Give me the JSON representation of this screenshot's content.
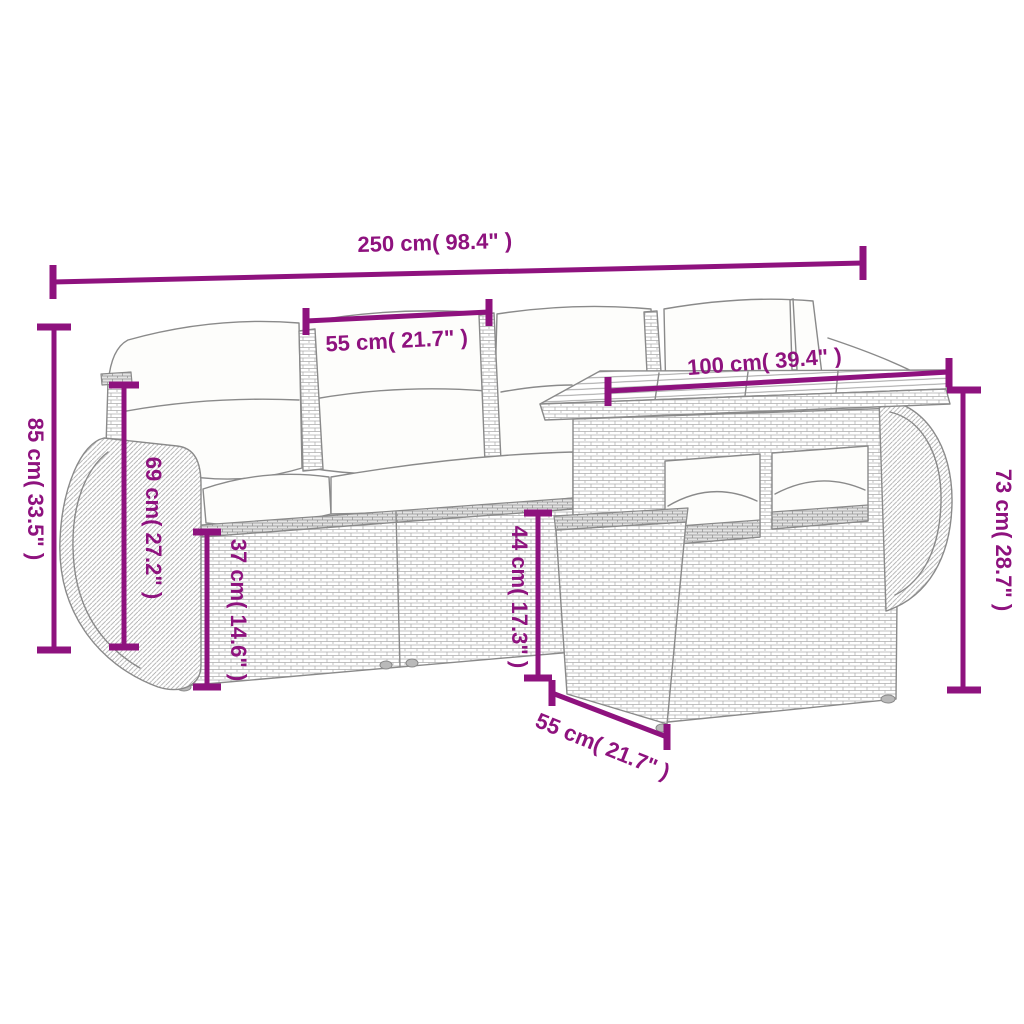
{
  "diagram": {
    "title": "Garden furniture set dimension diagram",
    "background_color": "#ffffff",
    "accent_color": "#8E127E",
    "line_art_color": "#8a8a8a",
    "dimensions": [
      {
        "id": "overall-width",
        "label": "250 cm( 98.4\" )",
        "value_cm": 250,
        "value_in": 98.4,
        "orientation": "horizontal",
        "position": "top"
      },
      {
        "id": "seat-section-width",
        "label": "55 cm( 21.7\" )",
        "value_cm": 55,
        "value_in": 21.7,
        "orientation": "horizontal",
        "position": "above middle back cushion"
      },
      {
        "id": "table-top-width",
        "label": "100 cm( 39.4\" )",
        "value_cm": 100,
        "value_in": 39.4,
        "orientation": "horizontal",
        "position": "above table top"
      },
      {
        "id": "overall-height",
        "label": "85 cm( 33.5\" )",
        "value_cm": 85,
        "value_in": 33.5,
        "orientation": "vertical",
        "position": "left edge"
      },
      {
        "id": "armrest-height",
        "label": "69 cm( 27.2\" )",
        "value_cm": 69,
        "value_in": 27.2,
        "orientation": "vertical",
        "position": "left armrest"
      },
      {
        "id": "seat-height",
        "label": "37 cm( 14.6\" )",
        "value_cm": 37,
        "value_in": 14.6,
        "orientation": "vertical",
        "position": "sofa seat base"
      },
      {
        "id": "ottoman-height",
        "label": "44 cm( 17.3\" )",
        "value_cm": 44,
        "value_in": 17.3,
        "orientation": "vertical",
        "position": "ottoman front"
      },
      {
        "id": "ottoman-width",
        "label": "55 cm( 21.7\" )",
        "value_cm": 55,
        "value_in": 21.7,
        "orientation": "diagonal",
        "position": "bottom front of ottoman"
      },
      {
        "id": "table-height",
        "label": "73 cm( 28.7\" )",
        "value_cm": 73,
        "value_in": 28.7,
        "orientation": "vertical",
        "position": "right edge"
      }
    ]
  }
}
